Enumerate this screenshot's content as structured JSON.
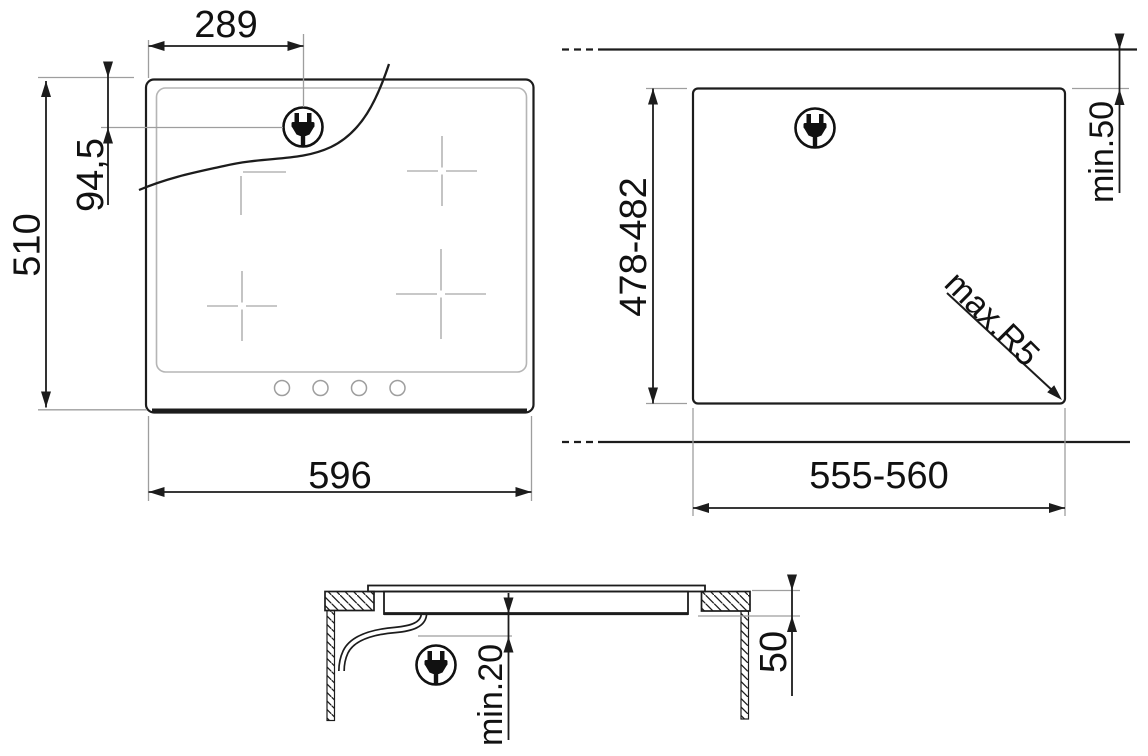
{
  "diagram": {
    "title": "hob-installation-drawing",
    "front_view": {
      "plug_offset_x": "289",
      "plug_offset_y": "94,5",
      "height": "510",
      "width": "596"
    },
    "cutout_view": {
      "height": "478-482",
      "width": "555-560",
      "rear_clearance": "min.50",
      "corner_radius": "max.R5"
    },
    "section_view": {
      "bottom_clearance": "min.20",
      "recess_depth": "50"
    },
    "colors": {
      "line": "#1c1c1c",
      "extension_line": "#9e9e9e",
      "light_detail": "#b5b5b5",
      "background": "#ffffff"
    }
  }
}
